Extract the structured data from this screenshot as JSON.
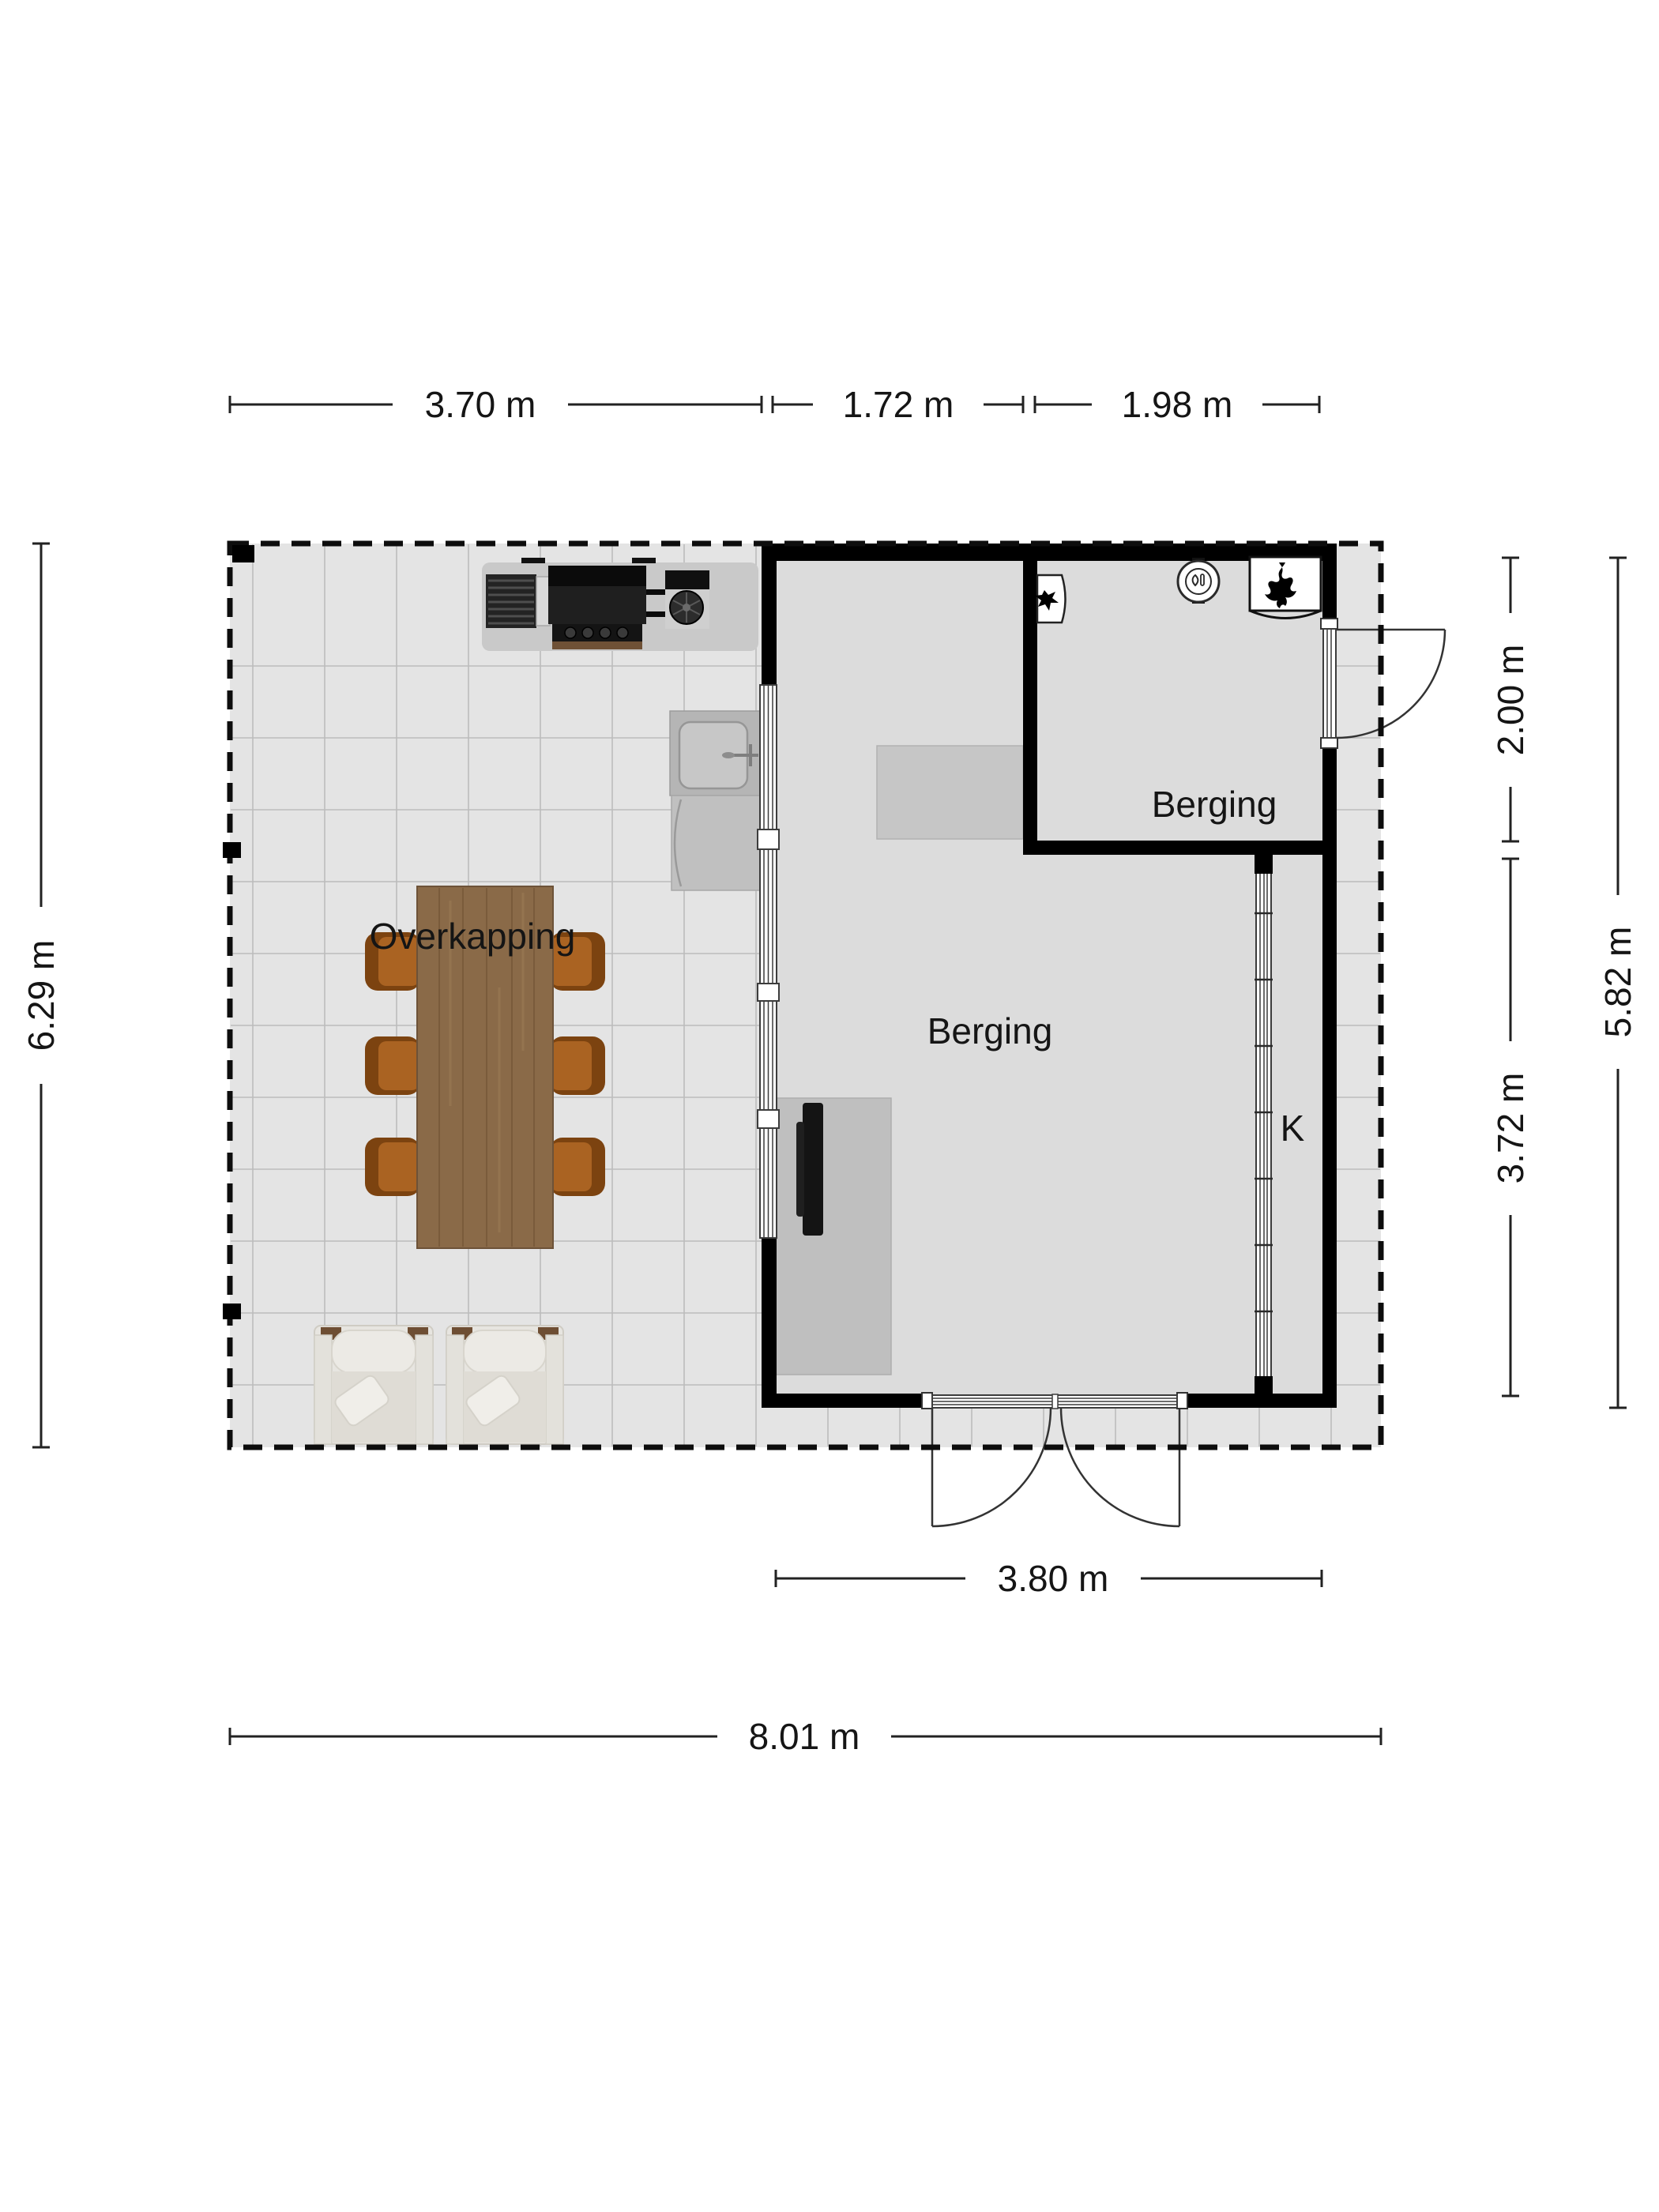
{
  "floor_plan": {
    "type": "2D floor plan",
    "rooms": {
      "overkapping": {
        "label": "Overkapping"
      },
      "berging_main": {
        "label": "Berging"
      },
      "berging_top": {
        "label": "Berging"
      },
      "closet": {
        "label": "K"
      }
    },
    "dimensions": {
      "top_left": {
        "label": "3.70 m"
      },
      "top_mid": {
        "label": "1.72 m"
      },
      "top_right": {
        "label": "1.98 m"
      },
      "left_total": {
        "label": "6.29 m"
      },
      "right_room": {
        "label": "2.00 m"
      },
      "right_main": {
        "label": "3.72 m"
      },
      "right_total": {
        "label": "5.82 m"
      },
      "bottom_doors": {
        "label": "3.80 m"
      },
      "bottom_total": {
        "label": "8.01 m"
      }
    },
    "icons": [
      "flame-icon",
      "boiler-icon",
      "wall-unit-icon",
      "sink",
      "bbq-grill",
      "door-swing"
    ],
    "colors": {
      "wall": "#000000",
      "patio_floor": "#e4e4e4",
      "interior_floor": "#dcdcdc",
      "tile_line": "#bcbcbc",
      "table_wood": "#8a6a48",
      "chair_wood": "#a9611f",
      "lounge_fabric": "#e7e5e0",
      "bbq_black": "#141414",
      "dim_line": "#222222"
    }
  }
}
